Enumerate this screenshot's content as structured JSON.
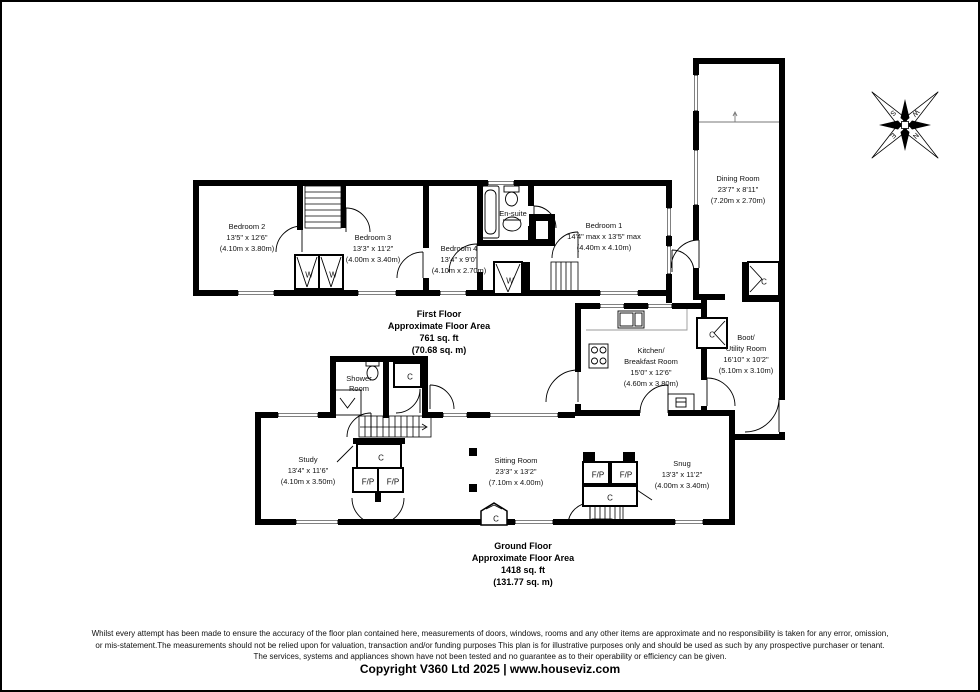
{
  "first_floor": {
    "title": "First Floor",
    "subtitle": "Approximate Floor Area",
    "area_imperial": "761 sq. ft",
    "area_metric": "(70.68 sq. m)",
    "rooms": {
      "bedroom2": {
        "name": "Bedroom 2",
        "dims": "13'5\" x 12'6\"",
        "metric": "(4.10m x 3.80m)"
      },
      "bedroom3": {
        "name": "Bedroom 3",
        "dims": "13'3\" x 11'2\"",
        "metric": "(4.00m x 3.40m)"
      },
      "bedroom4": {
        "name": "Bedroom 4",
        "dims": "13'4\" x 9'0\"",
        "metric": "(4.10m x 2.70m)"
      },
      "bedroom1": {
        "name": "Bedroom 1",
        "dims": "14'4\" max x 13'5\" max",
        "metric": "(4.40m x 4.10m)"
      },
      "ensuite": {
        "name": "En-suite"
      }
    }
  },
  "ground_floor": {
    "title": "Ground Floor",
    "subtitle": "Approximate Floor Area",
    "area_imperial": "1418 sq. ft",
    "area_metric": "(131.77 sq. m)",
    "rooms": {
      "dining": {
        "name": "Dining Room",
        "dims": "23'7\" x 8'11\"",
        "metric": "(7.20m x 2.70m)"
      },
      "kitchen": {
        "name_line1": "Kitchen/",
        "name_line2": "Breakfast Room",
        "dims": "15'0\" x 12'6\"",
        "metric": "(4.60m x 3.80m)"
      },
      "boot": {
        "name_line1": "Boot/",
        "name_line2": "Utility Room",
        "dims": "16'10\" x 10'2\"",
        "metric": "(5.10m x 3.10m)"
      },
      "snug": {
        "name": "Snug",
        "dims": "13'3\" x 11'2\"",
        "metric": "(4.00m x 3.40m)"
      },
      "sitting": {
        "name": "Sitting Room",
        "dims": "23'3\" x 13'2\"",
        "metric": "(7.10m x 4.00m)"
      },
      "study": {
        "name": "Study",
        "dims": "13'4\" x 11'6\"",
        "metric": "(4.10m x 3.50m)"
      },
      "shower": {
        "name_line1": "Shower",
        "name_line2": "Room"
      }
    }
  },
  "markers": {
    "wardrobe": "W",
    "cupboard": "C",
    "fireplace": "F/P"
  },
  "compass": {
    "n": "N",
    "e": "E",
    "s": "S",
    "w": "W"
  },
  "footer": {
    "disclaimer_line1": "Whilst every attempt has been made to ensure the accuracy of the floor plan contained here, measurements of doors, windows, rooms and any other items are approximate and no responsibility is taken for any error, omission,",
    "disclaimer_line2": "or mis-statement.The measurements should not be relied upon for valuation, transaction and/or funding purposes This plan is for illustrative purposes only and should be used as such by any prospective purchaser or tenant.",
    "disclaimer_line3": "The services, systems and appliances shown have not been tested and no guarantee as to their operability or efficiency can be given.",
    "copyright": "Copyright V360 Ltd 2025 | www.houseviz.com"
  }
}
